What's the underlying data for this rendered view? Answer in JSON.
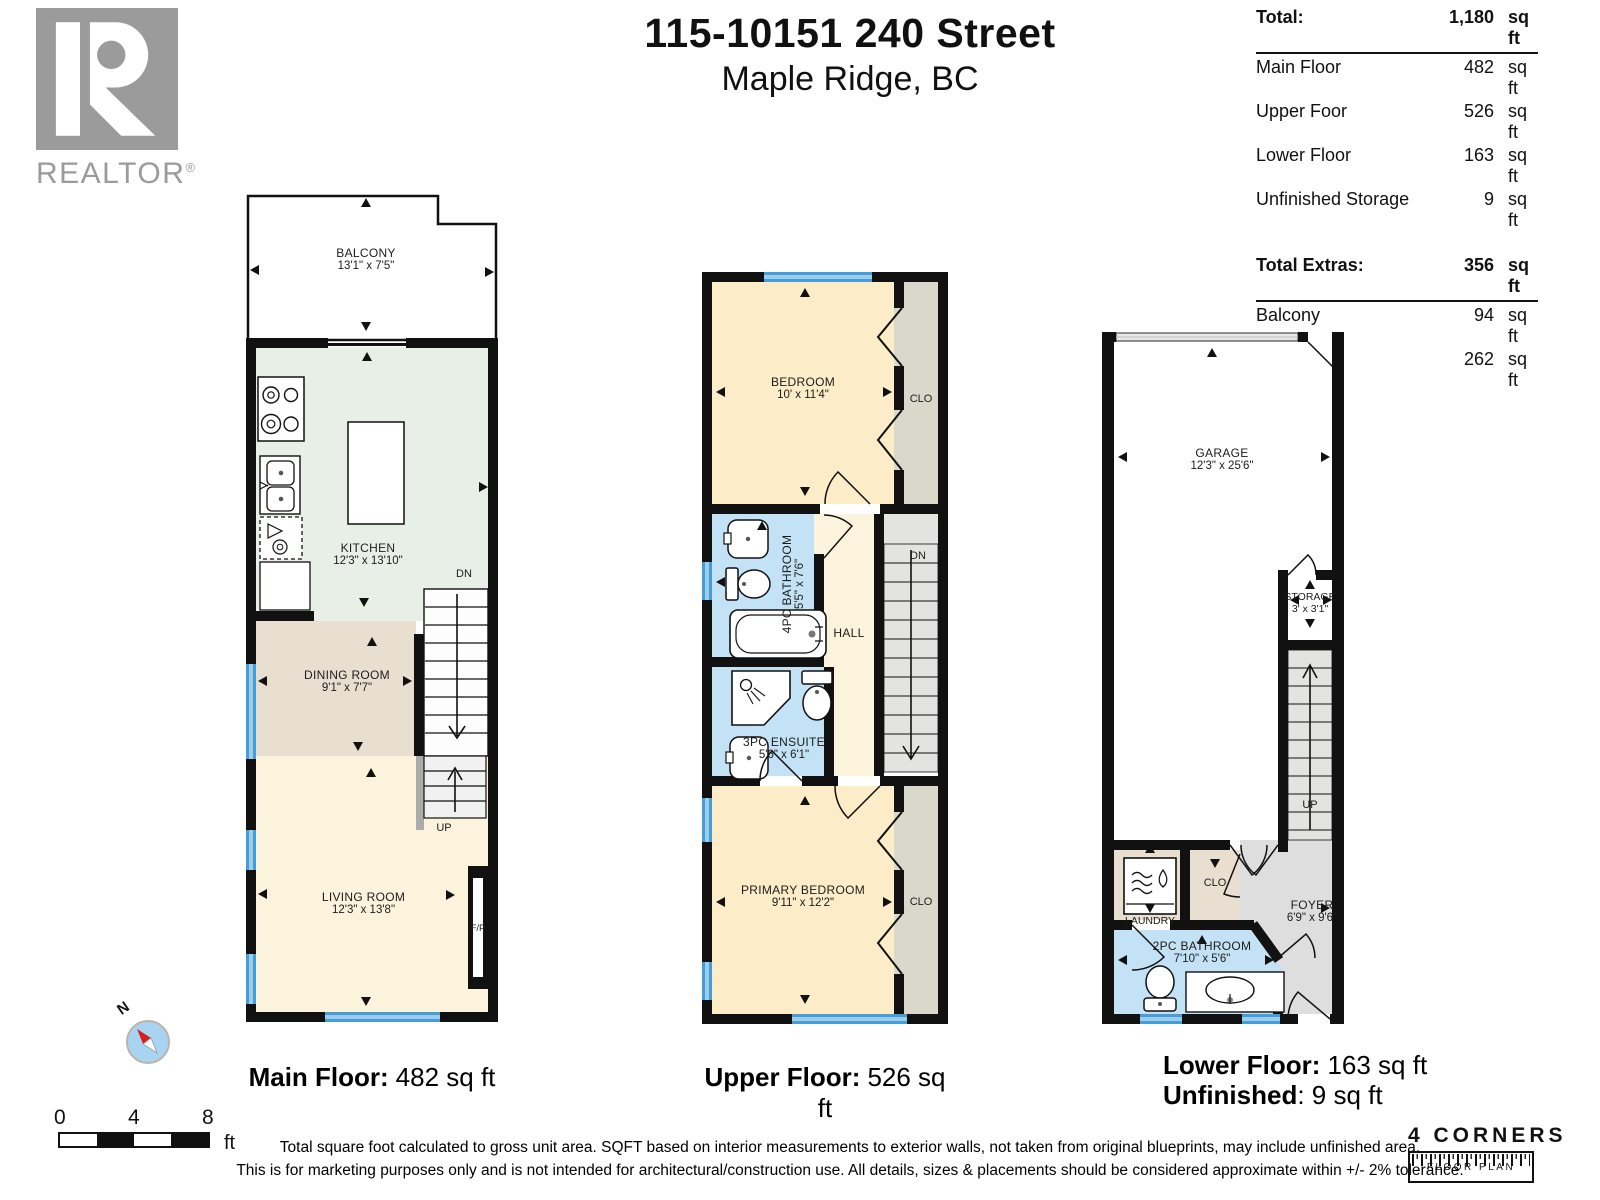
{
  "header": {
    "title": "115-10151 240 Street",
    "subtitle": "Maple Ridge, BC"
  },
  "realtor": {
    "brand": "REALTOR",
    "registered": "®"
  },
  "area_table": {
    "total_label": "Total:",
    "total_value": "1,180",
    "total_unit": "sq ft",
    "rows": [
      {
        "label": "Main Floor",
        "value": "482",
        "unit": "sq ft"
      },
      {
        "label": "Upper Foor",
        "value": "526",
        "unit": "sq ft"
      },
      {
        "label": "Lower Floor",
        "value": "163",
        "unit": "sq ft"
      },
      {
        "label": "Unfinished Storage",
        "value": "9",
        "unit": "sq ft"
      }
    ],
    "extras_label": "Total Extras:",
    "extras_value": "356",
    "extras_unit": "sq ft",
    "extras_rows": [
      {
        "label": "Balcony",
        "value": "94",
        "unit": "sq ft"
      },
      {
        "label": "Garage",
        "value": "262",
        "unit": "sq ft"
      }
    ]
  },
  "floors": {
    "main": {
      "caption_label": "Main Floor:",
      "caption_value": "482 sq ft",
      "balcony_name": "BALCONY",
      "balcony_dims": "13'1\" x 7'5\"",
      "kitchen_name": "KITCHEN",
      "kitchen_dims": "12'3\" x 13'10\"",
      "dining_name": "DINING ROOM",
      "dining_dims": "9'1\" x 7'7\"",
      "living_name": "LIVING ROOM",
      "living_dims": "12'3\" x 13'8\"",
      "dn": "DN",
      "up": "UP",
      "fp": "F/P"
    },
    "upper": {
      "caption_label": "Upper Floor:",
      "caption_value": "526 sq ft",
      "bedroom_name": "BEDROOM",
      "bedroom_dims": "10' x 11'4\"",
      "bath_name": "4PC BATHROOM",
      "bath_dims": "5'5\" x 7'6\"",
      "ensuite_name": "3PC ENSUITE",
      "ensuite_dims": "5'6\" x 6'1\"",
      "hall": "HALL",
      "dn": "DN",
      "primary_name": "PRIMARY BEDROOM",
      "primary_dims": "9'11\" x 12'2\"",
      "clo1": "CLO",
      "clo2": "CLO"
    },
    "lower": {
      "caption_label": "Lower Floor:",
      "caption_value": "163 sq ft",
      "caption2_label": "Unfinished",
      "caption2_value": ": 9 sq ft",
      "garage_name": "GARAGE",
      "garage_dims": "12'3\" x 25'6\"",
      "storage_name": "STORAGE",
      "storage_dims": "3' x 3'1\"",
      "laundry": "LAUNDRY",
      "clo": "CLO",
      "foyer_name": "FOYER",
      "foyer_dims": "6'9\" x 9'6\"",
      "bath_name": "2PC BATHROOM",
      "bath_dims": "7'10\" x 5'6\"",
      "up": "UP"
    }
  },
  "scale_bar": {
    "tick0": "0",
    "tick4": "4",
    "tick8": "8",
    "unit": "ft"
  },
  "compass": {
    "north": "N"
  },
  "disclaimer": {
    "line1": "Total square foot calculated to gross unit area. SQFT based on interior measurements to exterior walls, not taken from original blueprints, may include unfinished area.",
    "line2": "This is for marketing purposes only and is not intended for architectural/construction use.  All details, sizes & placements should be considered approximate within +/- 2%  tolerance."
  },
  "branding": {
    "name": "4 CORNERS",
    "tagline": "FLOOR PLAN"
  }
}
